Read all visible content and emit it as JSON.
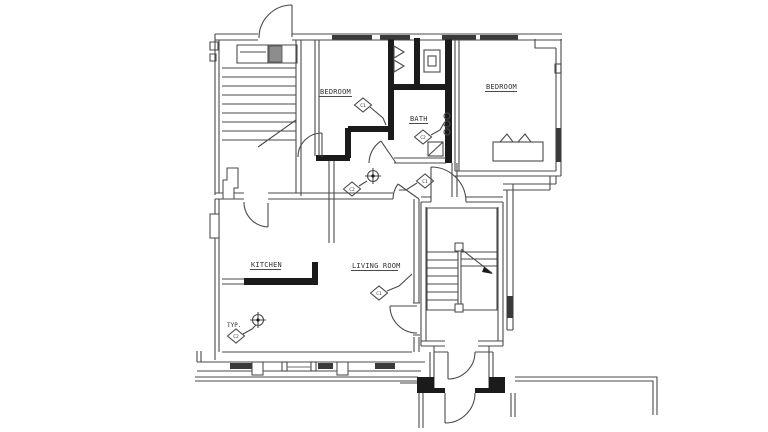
{
  "drawing": {
    "type": "architectural floor plan",
    "colors": {
      "paper": "#ffffff",
      "thin_line": "#4a4a4a",
      "wall_poche": "#1b1b1b",
      "window_sill": "#3a3a3a"
    },
    "room_labels": {
      "bedroom_left": "BEDROOM",
      "bath": "BATH",
      "bedroom_right": "BEDROOM",
      "kitchen": "KITCHEN",
      "living_room": "LIVING ROOM",
      "typical_note": "TYP."
    },
    "fixture_tags": {
      "bedroom_left": "C1",
      "bath": "C2",
      "hall_west": "C2",
      "hall_east": "C1",
      "living_room": "C1",
      "kitchen_typical": "C2"
    },
    "symbols": {
      "ceiling_light": "circle-cross light fixture",
      "exhaust_fan": "square with diagonal",
      "stairs": "tread lines with direction arrow",
      "radiator": "rectangle with two triangles"
    }
  }
}
